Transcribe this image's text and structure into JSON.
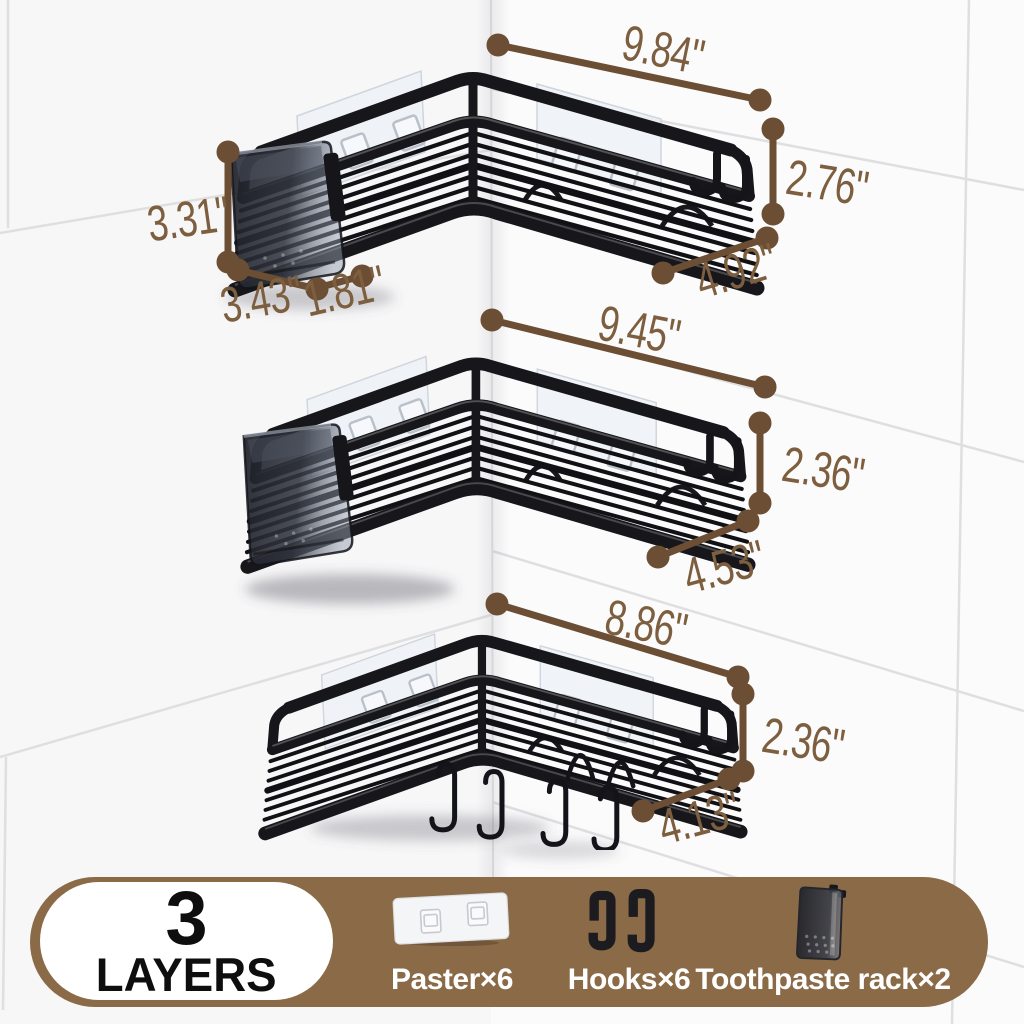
{
  "colors": {
    "dimension_line": "#6b4e34",
    "dimension_text": "#7d5f3f",
    "banner_bg": "#8a6a47",
    "banner_text": "#ffffff",
    "pill_bg": "#ffffff",
    "pill_text": "#0e0e0e",
    "wall": "#fbfbfc",
    "grout": "#dfdfe2",
    "basket_black": "#17171b"
  },
  "dimensions": {
    "shelf1": {
      "width": "9.84\"",
      "height": "2.76\"",
      "depth": "4.92\""
    },
    "toothpaste_cup": {
      "height": "3.31\"",
      "width": "3.43\"",
      "depth": "1.81\""
    },
    "shelf2": {
      "width": "9.45\"",
      "height": "2.36\"",
      "depth": "4.53\""
    },
    "shelf3": {
      "width": "8.86\"",
      "height": "2.36\"",
      "depth": "4.13\""
    }
  },
  "banner": {
    "layers_number": "3",
    "layers_word": "LAYERS",
    "items": [
      {
        "icon": "paster-icon",
        "label": "Paster×6"
      },
      {
        "icon": "hooks-icon",
        "label": "Hooks×6"
      },
      {
        "icon": "toothpaste-rack-icon",
        "label": "Toothpaste rack×2"
      }
    ]
  }
}
